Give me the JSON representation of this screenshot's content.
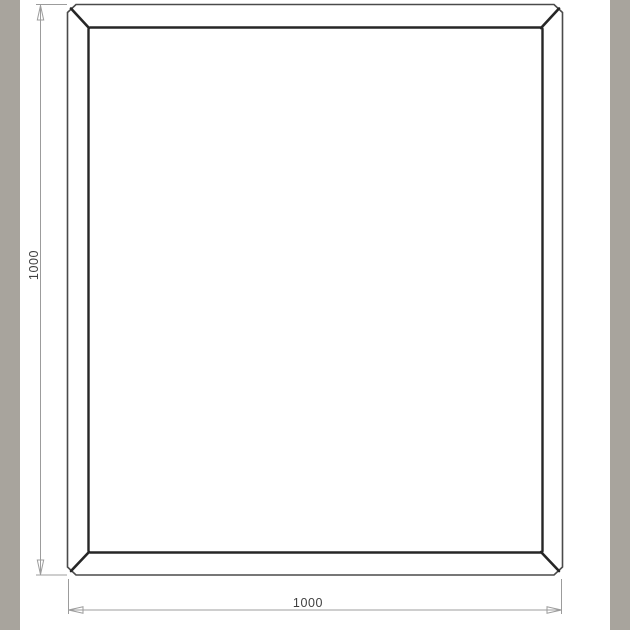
{
  "drawing": {
    "title": "frame-technical-drawing",
    "height_dimension": "1000",
    "width_dimension": "1000"
  },
  "colors": {
    "letterbox_gray": "#a8a49d",
    "frame_outer_line": "#4a4a4a",
    "frame_inner_line": "#262626",
    "dimension_line": "#9c9c9c",
    "dimension_text": "#3f3f3f",
    "canvas_background": "#ffffff"
  }
}
